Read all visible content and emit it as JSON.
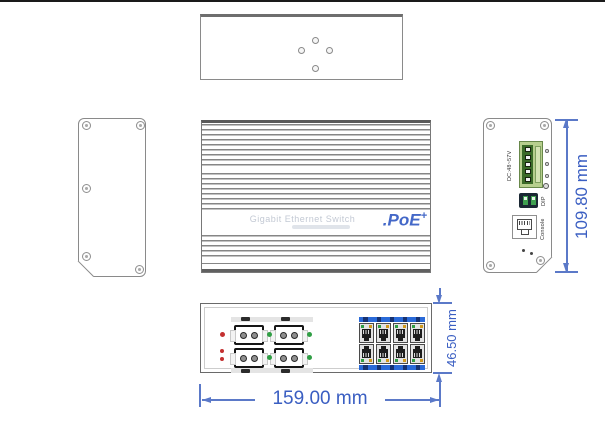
{
  "colors": {
    "dim_line": "#5b79c8",
    "dim_text": "#3a5ec2",
    "poe_blue": "#4468c8",
    "brand_gray": "#c3c9d4",
    "led_red": "#c43030",
    "led_green": "#2f9e44",
    "bar_blue": "#2a6ad8",
    "terminal_green": "#b7cf8e",
    "line_gray": "#8a8a8a"
  },
  "front_view": {
    "brand": "Gigabit Ethernet Switch",
    "poe": ".PoE",
    "poe_sup": "+"
  },
  "right_view": {
    "power_label": "DC:48~57V",
    "dip_label": "DIP",
    "console_label": "Console"
  },
  "dimensions": {
    "height": "109.80 mm",
    "width": "159.00 mm",
    "depth": "46.50 mm"
  }
}
